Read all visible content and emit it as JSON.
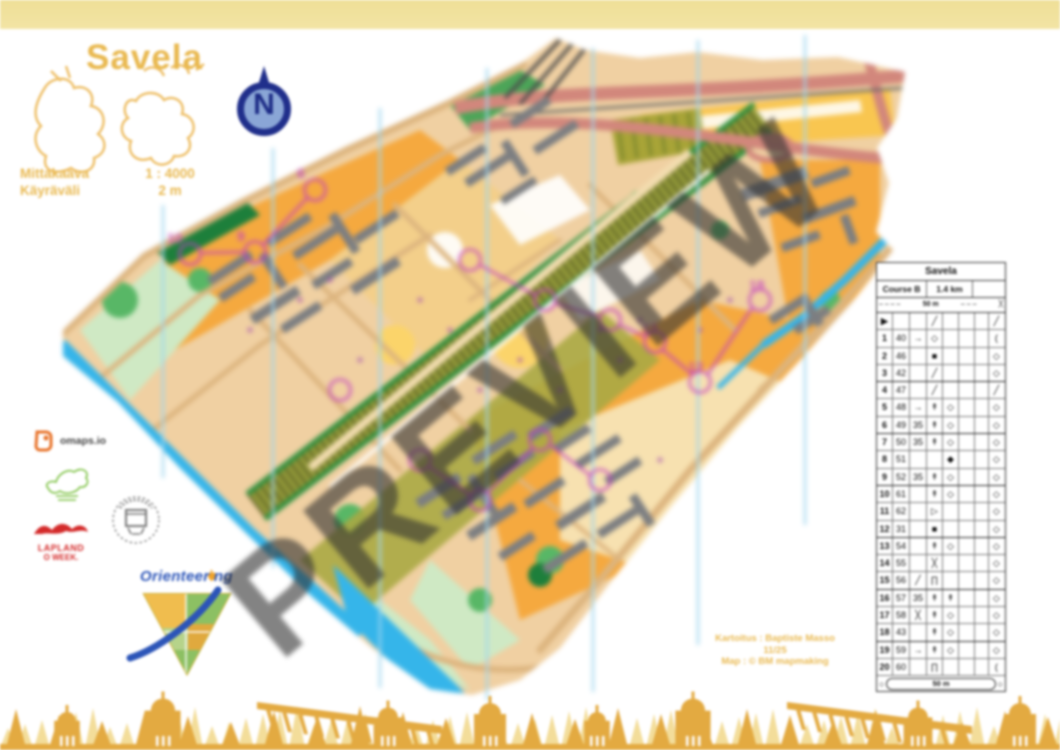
{
  "colors": {
    "gold": "#e9b951",
    "band": "#f0e09b",
    "deco_light": "#f3dd9a",
    "deco_dark": "#e3aa41",
    "water": "#35b5ea",
    "magenta": "#c33fc3",
    "navy": "#202f8b",
    "salmon": "#d2877c"
  },
  "header": {
    "title": "Savela",
    "scale_label": "Mittakaava",
    "scale_value": "1 : 4000",
    "contour_label": "Käyräväli",
    "contour_value": "2 m",
    "north_letter": "N"
  },
  "watermark": "PREVIEW",
  "credits": {
    "line1": "Kartoitus : Baptiste Masso",
    "line2": "11/25",
    "line3": "Map : © BM mapmaking"
  },
  "logos": {
    "omaps": "omaps.io",
    "lapland_line1": "LAPLAND",
    "lapland_line2": "O WEEK.",
    "orienteering_part1": "Orienteer",
    "orienteering_part2": "ng"
  },
  "map": {
    "course_numbers": [
      "6",
      "9",
      "10",
      "12",
      "13",
      "18"
    ]
  },
  "control_table": {
    "title": "Savela",
    "course": "Course B",
    "length": "1.4 km",
    "climb": "",
    "info_row": {
      "left_dashes": "– – – –",
      "distance": "50 m",
      "right_dashes": "– – –",
      "symbol": "╳"
    },
    "start_row": [
      "▶",
      "",
      "",
      "╱",
      "",
      "",
      "",
      "╱"
    ],
    "rows": [
      [
        "1",
        "40",
        "→",
        "◇",
        "",
        "",
        "",
        "("
      ],
      [
        "2",
        "46",
        "",
        "■",
        "",
        "",
        "",
        "◇"
      ],
      [
        "3",
        "42",
        "",
        "╱",
        "",
        "",
        "",
        "◇"
      ],
      [
        "4",
        "47",
        "",
        "╱",
        "",
        "",
        "",
        "╱"
      ],
      [
        "5",
        "48",
        "→",
        "↟",
        "◇",
        "",
        "",
        "◇"
      ],
      [
        "6",
        "49",
        "35",
        "↟",
        "◇",
        "",
        "",
        "◇"
      ],
      [
        "7",
        "50",
        "35",
        "↟",
        "◇",
        "",
        "",
        "◇"
      ],
      [
        "8",
        "51",
        "",
        "",
        "◆",
        "",
        "",
        "◇"
      ],
      [
        "9",
        "52",
        "35",
        "↟",
        "◇",
        "",
        "",
        "◇"
      ],
      [
        "10",
        "61",
        "",
        "↟",
        "◇",
        "",
        "",
        "◇"
      ],
      [
        "11",
        "62",
        "",
        "▷",
        "",
        "",
        "",
        "◇"
      ],
      [
        "12",
        "31",
        "",
        "■",
        "",
        "",
        "",
        "◇"
      ],
      [
        "13",
        "54",
        "",
        "↟",
        "◇",
        "",
        "",
        "◇"
      ],
      [
        "14",
        "55",
        "",
        "╳",
        "",
        "",
        "",
        "◇"
      ],
      [
        "15",
        "56",
        "╱",
        "∏",
        "",
        "",
        "",
        "◇"
      ],
      [
        "16",
        "57",
        "35",
        "↟",
        "↟",
        "",
        "",
        "◇"
      ],
      [
        "17",
        "58",
        "╳",
        "↟",
        "◇",
        "",
        "",
        "◇"
      ],
      [
        "18",
        "43",
        "",
        "↟",
        "◇",
        "",
        "",
        "◇"
      ],
      [
        "19",
        "59",
        "→",
        "↟",
        "◇",
        "",
        "",
        "◇"
      ],
      [
        "20",
        "60",
        "",
        "∏",
        "",
        "",
        "",
        "("
      ]
    ],
    "finish": {
      "left": "○",
      "distance": "50 m",
      "right": "○"
    }
  }
}
